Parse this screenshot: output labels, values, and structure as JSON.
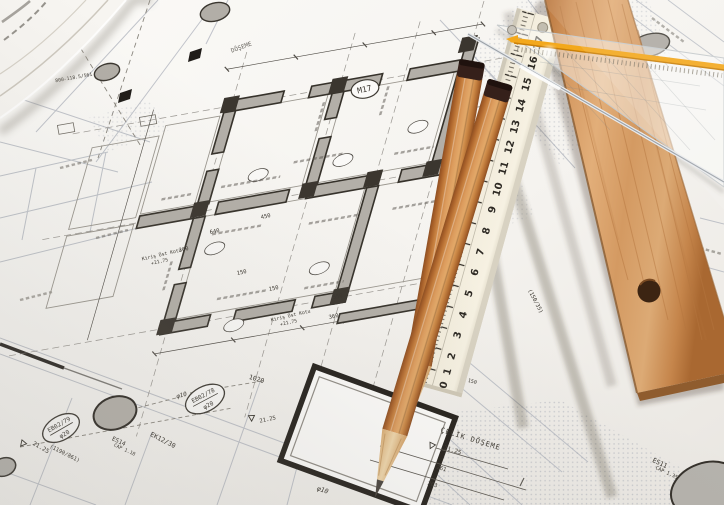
{
  "plan": {
    "stamp_m17": "M17",
    "deck_label": "ÇELİK DÖŞEME",
    "deck_label_partial": "DÖŞEME",
    "beam_note_line1": "Kiriş Üst Kotu",
    "beam_note_line2": "+21.75",
    "level": "21.25",
    "ref_code": "800-118.5/561",
    "pair_code": "(1190/861)",
    "beam_code": "EK12/30",
    "beam_size": "(150/35)",
    "phi10": "φ10",
    "phi20": "φ20",
    "dims": [
      "450",
      "640",
      "360",
      "150",
      "550",
      "360",
      "150",
      "1020",
      "140",
      "150",
      "261",
      "263"
    ]
  },
  "stamps": {
    "eb0278": "EB02/78",
    "eb0279": "EB02/79",
    "es14": "ES14",
    "es14_cap": "CAP 1.18",
    "es11": "ES11",
    "es11_cap": "CAP 1.35"
  },
  "folding_ruler": {
    "numbers": [
      "17",
      "16",
      "15",
      "14",
      "13",
      "12",
      "11",
      "10",
      "9",
      "8",
      "7",
      "6",
      "5",
      "4",
      "3",
      "2",
      "1",
      "0"
    ]
  }
}
